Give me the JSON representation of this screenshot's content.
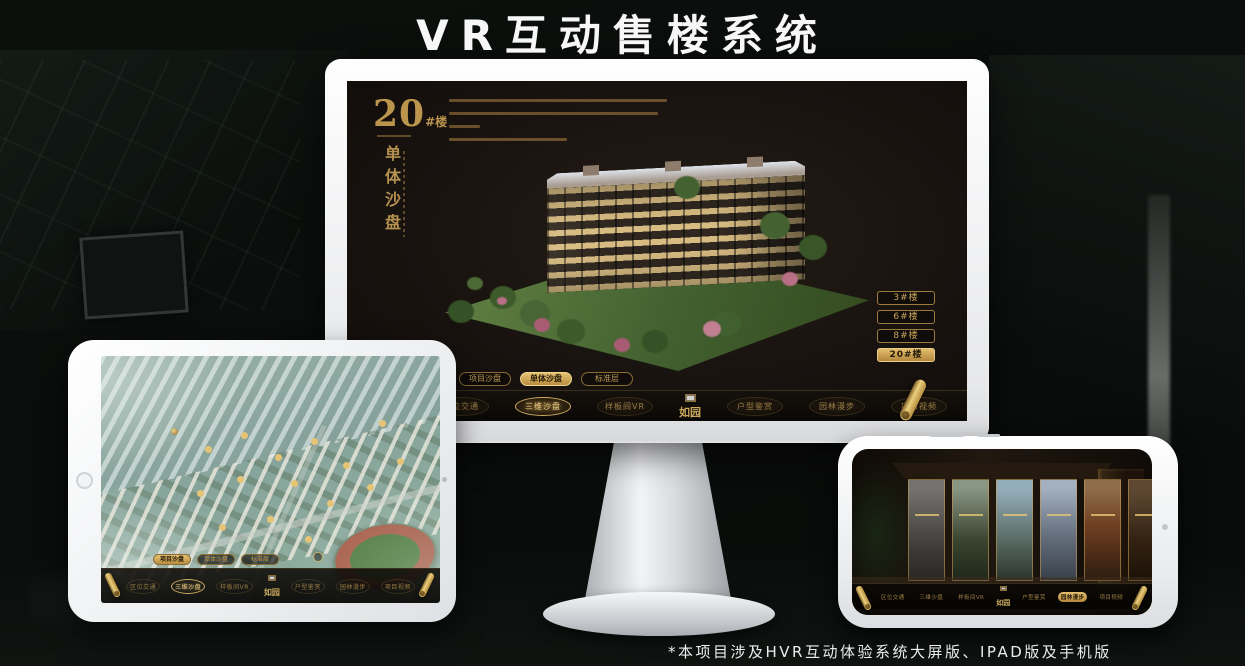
{
  "page": {
    "title": "VR互动售楼系统",
    "footnote": "*本项目涉及HVR互动体验系统大屏版、IPAD版及手机版"
  },
  "brand": {
    "name": "如园"
  },
  "colors": {
    "gold": "#c7a355",
    "gold_bright": "#ecd07d",
    "screen_brown": "#1b1410",
    "title_white": "#f7f7f7"
  },
  "monitor_ui": {
    "building_no": "20",
    "building_unit": "#楼",
    "vertical_title": "单体沙盘",
    "floor_buttons": [
      {
        "label": "3#楼",
        "active": false
      },
      {
        "label": "6#楼",
        "active": false
      },
      {
        "label": "8#楼",
        "active": false
      },
      {
        "label": "20#楼",
        "active": true
      }
    ],
    "sub_tabs": [
      {
        "label": "项目沙盘",
        "active": false
      },
      {
        "label": "单体沙盘",
        "active": true
      },
      {
        "label": "标准层",
        "active": false
      }
    ],
    "nav_items": [
      {
        "label": "区位交通",
        "active": false
      },
      {
        "label": "三维沙盘",
        "active": true
      },
      {
        "label": "样板间VR",
        "active": false
      },
      {
        "label": "户型鉴赏",
        "active": false
      },
      {
        "label": "园林漫步",
        "active": false
      },
      {
        "label": "项目视频",
        "active": false
      }
    ]
  },
  "tablet_ui": {
    "sub_tabs": [
      {
        "label": "项目沙盘",
        "active": true
      },
      {
        "label": "单体沙盘",
        "active": false
      },
      {
        "label": "标准层",
        "active": false
      }
    ],
    "nav_items": [
      {
        "label": "区位交通",
        "active": false
      },
      {
        "label": "三维沙盘",
        "active": true
      },
      {
        "label": "样板间VR",
        "active": false
      },
      {
        "label": "户型鉴赏",
        "active": false
      },
      {
        "label": "园林漫步",
        "active": false
      },
      {
        "label": "项目视频",
        "active": false
      }
    ]
  },
  "phone_ui": {
    "nav_items": [
      {
        "label": "区位交通",
        "active": false
      },
      {
        "label": "三维沙盘",
        "active": false
      },
      {
        "label": "样板间VR",
        "active": false
      },
      {
        "label": "户型鉴赏",
        "active": false
      },
      {
        "label": "园林漫步",
        "active": true
      },
      {
        "label": "项目视频",
        "active": false
      }
    ]
  }
}
